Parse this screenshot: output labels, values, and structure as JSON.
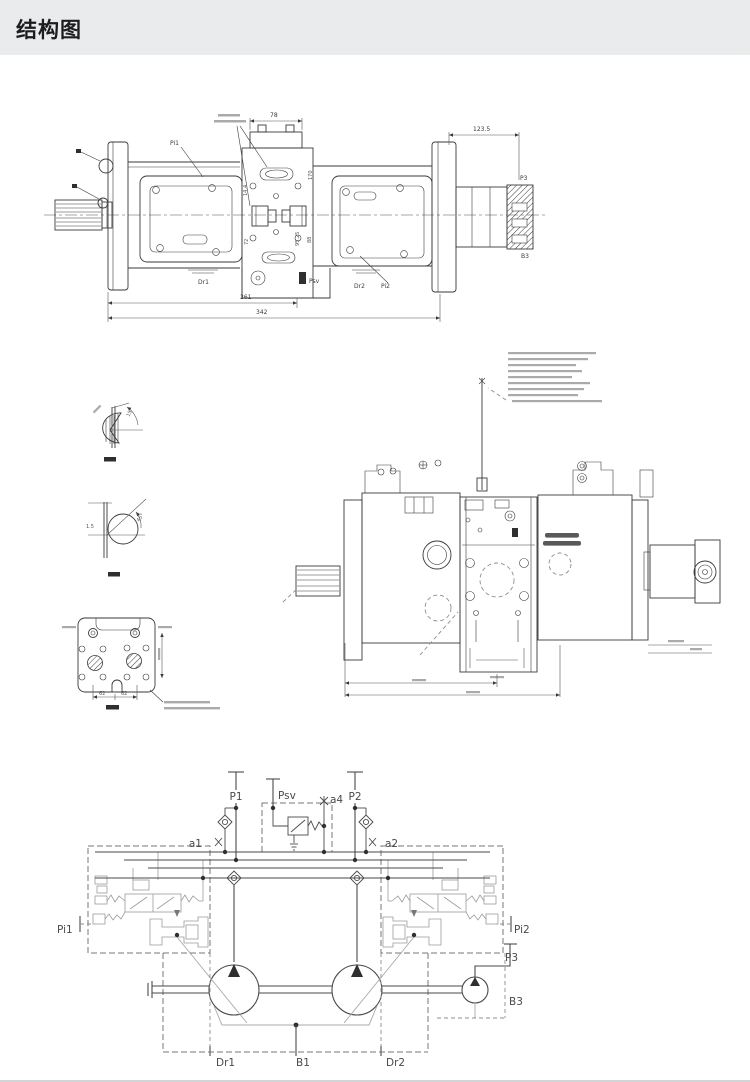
{
  "header": {
    "title": "结构图"
  },
  "side_view": {
    "dim_top_center": "78",
    "dim_top_right": "123.5",
    "dim_bottom_inner": "261",
    "dim_bottom_outer": "342",
    "port_pi1": "Pi1",
    "port_dr1": "Dr1",
    "port_psv": "Psv",
    "port_dr2": "Dr2",
    "port_pi2": "Pi2",
    "port_p3": "P3",
    "port_b3": "B3",
    "rot_dims": [
      "14.4",
      "72",
      "95.25",
      "88",
      "170"
    ]
  },
  "detail_views": {
    "top_angle": "15°",
    "bottom_angle": "45°",
    "bottom_dim": "1.5",
    "flange_dim_left": "62",
    "flange_dim_right": "62"
  },
  "schematic": {
    "port_p1": "P1",
    "port_psv": "Psv",
    "port_a4": "a4",
    "port_p2": "P2",
    "port_a1": "a1",
    "port_a2": "a2",
    "port_pi1": "Pi1",
    "port_pi2": "Pi2",
    "port_p3": "P3",
    "port_b3": "B3",
    "port_dr1": "Dr1",
    "port_b1": "B1",
    "port_dr2": "Dr2"
  }
}
